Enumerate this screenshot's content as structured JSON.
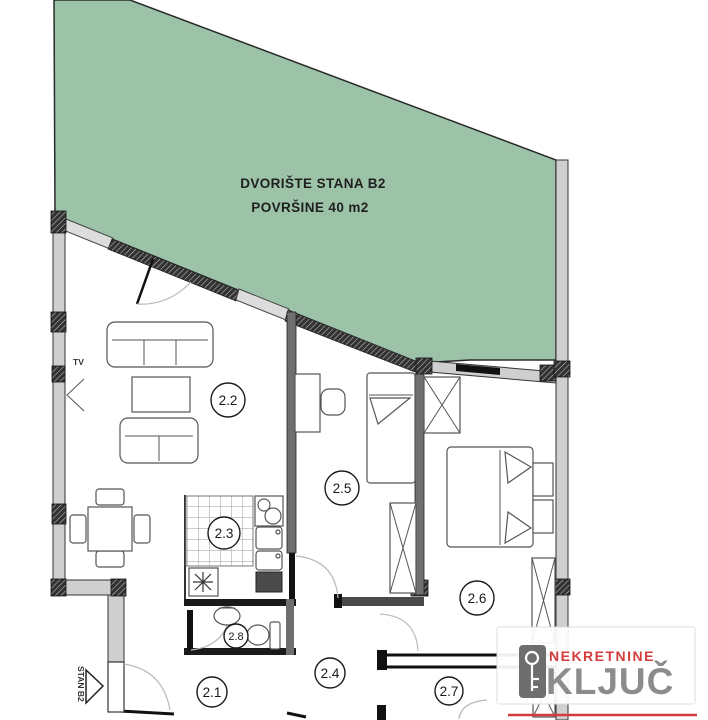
{
  "courtyard": {
    "line1": "DVORIŠTE STANA B2",
    "line2": "POVRŠINE 40 m2"
  },
  "rooms": [
    {
      "label": "2.1"
    },
    {
      "label": "2.2"
    },
    {
      "label": "2.3"
    },
    {
      "label": "2.4"
    },
    {
      "label": "2.5"
    },
    {
      "label": "2.6"
    },
    {
      "label": "2.7"
    },
    {
      "label": "2.8"
    }
  ],
  "annotations": {
    "tv_label": "TV",
    "entrance_label": "STAN B2"
  },
  "logo": {
    "brand_top": "NEKRETNINE",
    "brand_bottom": "KLJUČ"
  },
  "colors": {
    "courtyard_green": "#9cc2a7",
    "wall_gray": "#cfcfcf",
    "logo_red": "#d43b3b",
    "logo_gray": "#8c8c8c"
  }
}
